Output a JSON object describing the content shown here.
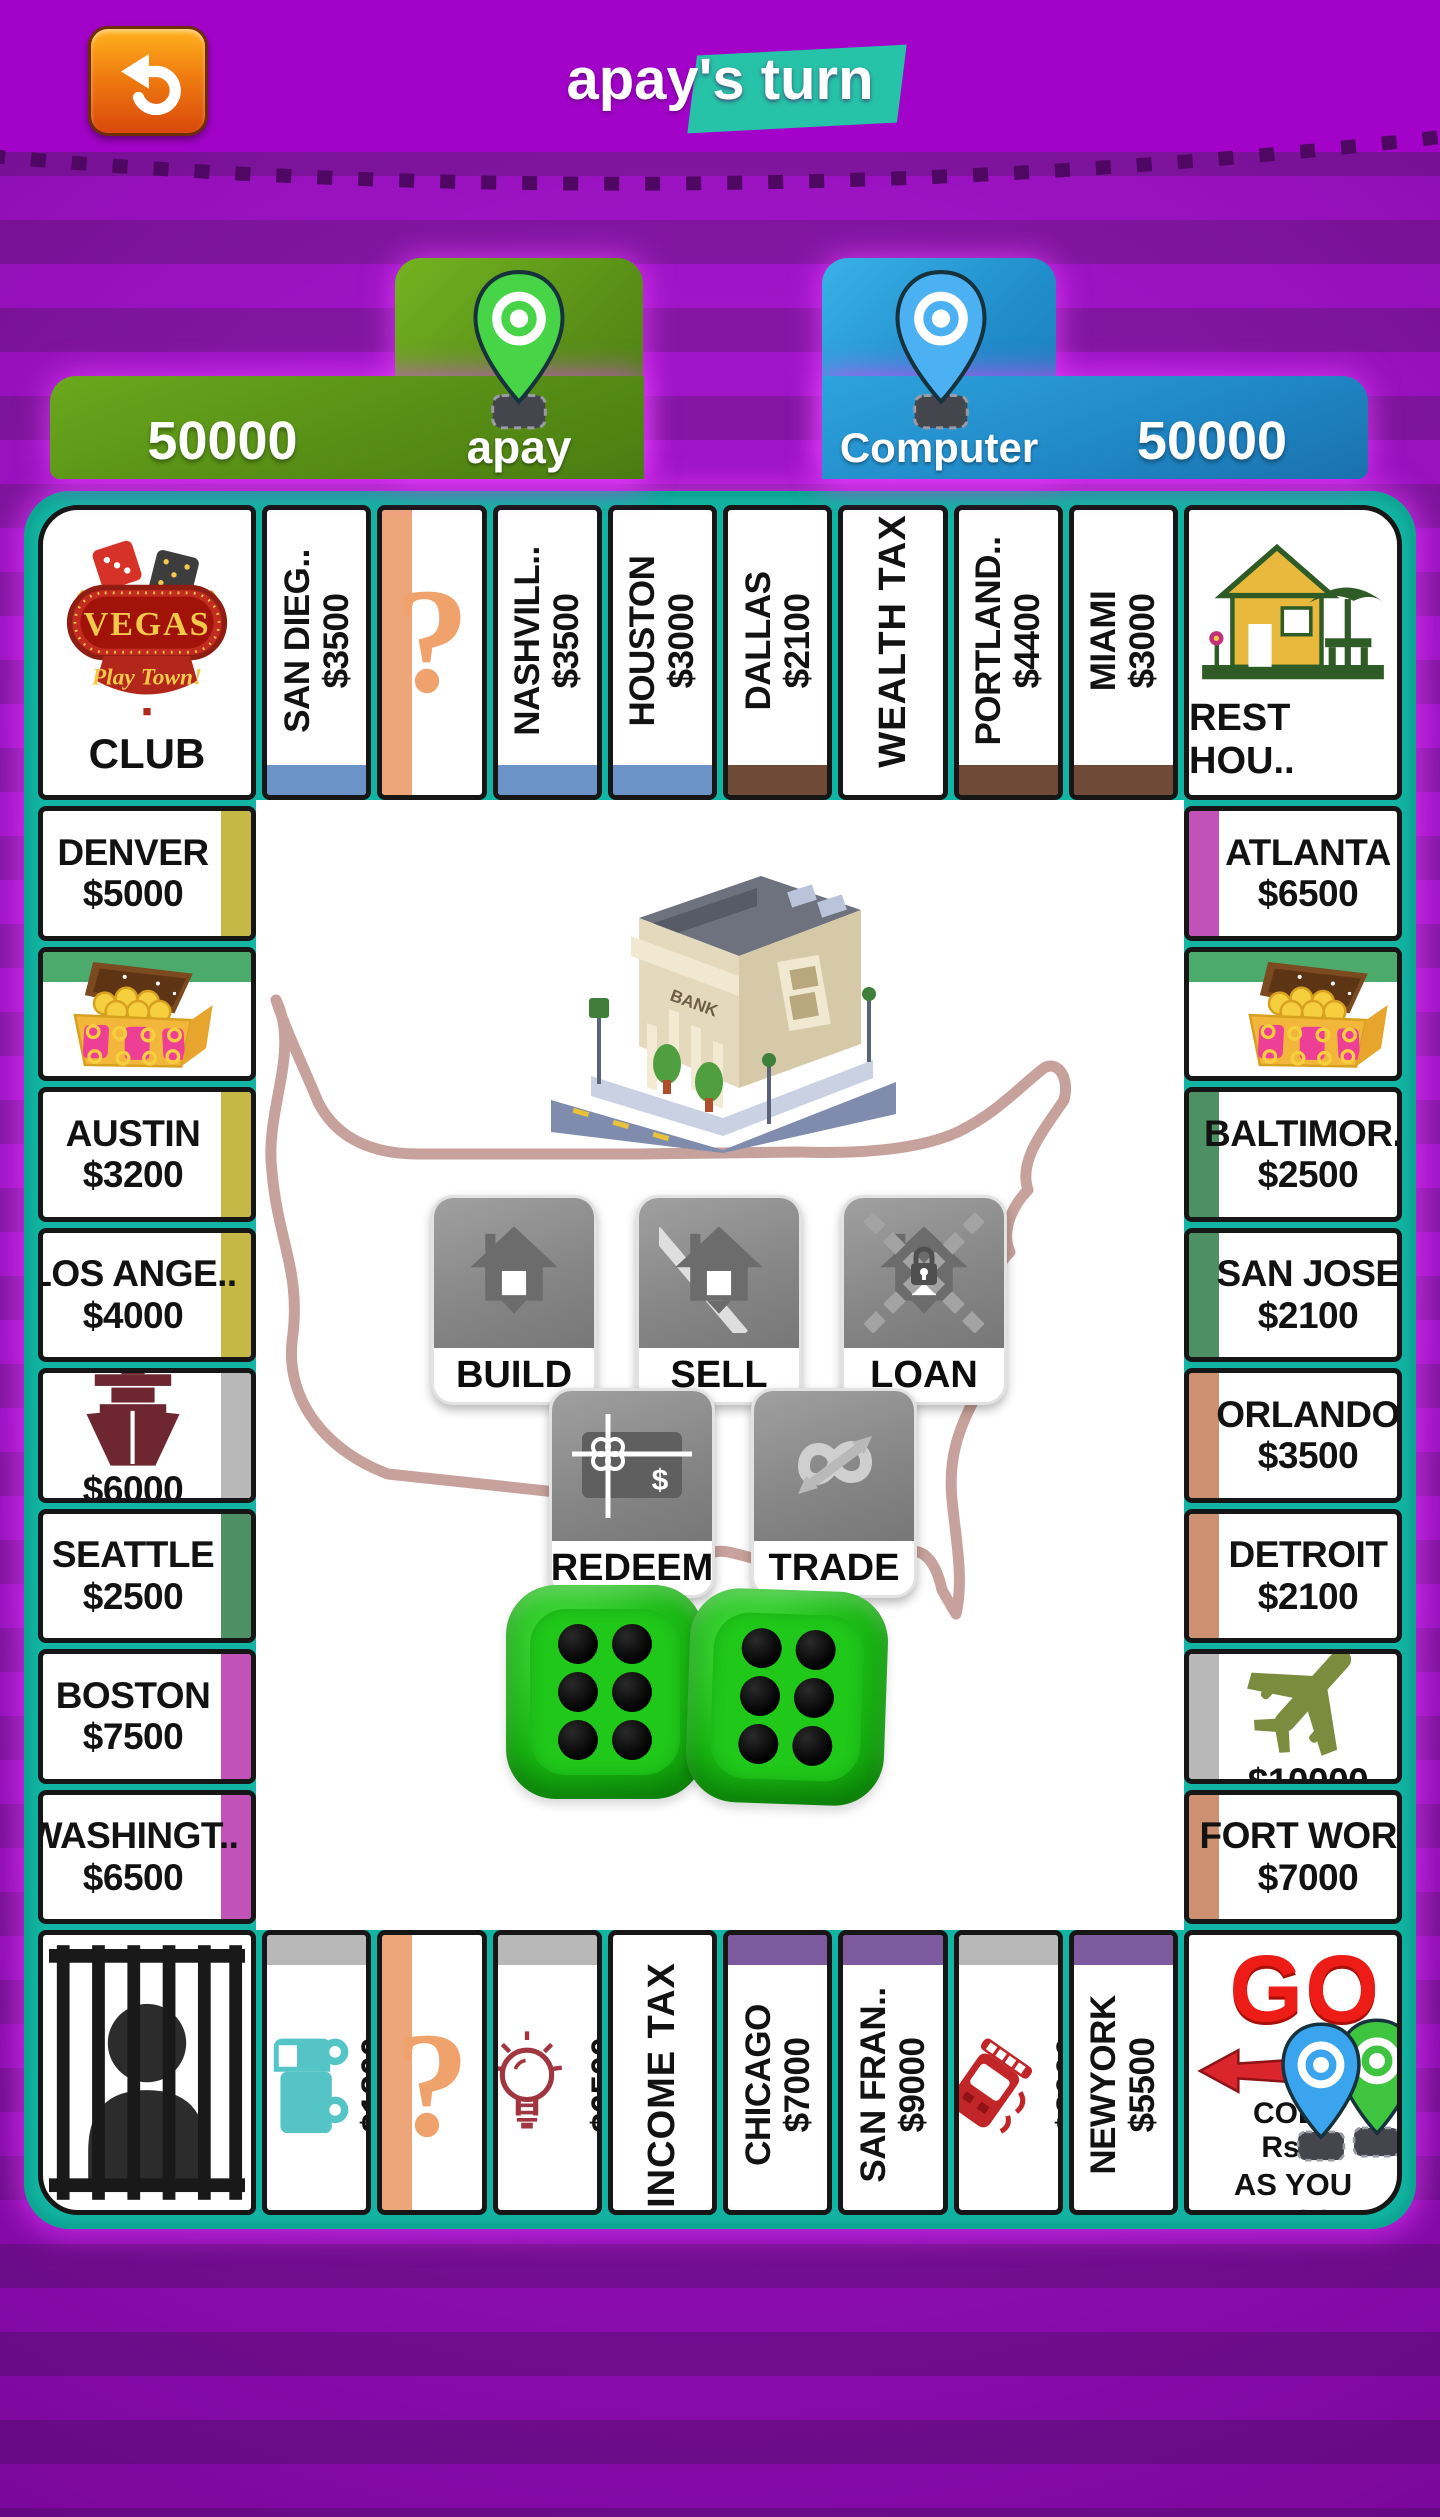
{
  "header": {
    "title": "apay's turn",
    "back_icon": "undo-arrow-icon"
  },
  "players": [
    {
      "name": "apay",
      "balance": "50000",
      "panel_color": "#5a9216",
      "pin_color": "#47d447"
    },
    {
      "name": "Computer",
      "balance": "50000",
      "panel_color": "#2191cf",
      "pin_color": "#4cb1f2"
    }
  ],
  "board": {
    "frame_color": "#12b5a3",
    "corners": {
      "top_left": {
        "sign_word": "VEGAS",
        "sign_script": "Play Town!",
        "label": "CLUB"
      },
      "top_right": {
        "label": "REST HOU.."
      },
      "bottom_left": {
        "icon": "jail-icon"
      },
      "bottom_right": {
        "word": "GO",
        "line1": "COL..",
        "line2": "Rs...",
        "line3": "AS YOU PASS"
      }
    },
    "top_row": [
      {
        "type": "city",
        "name": "SAN DIEG..",
        "price": "$3500",
        "band": "#6b93c7"
      },
      {
        "type": "chance",
        "symbol": "?",
        "band": "#eda57a",
        "band_side": "left"
      },
      {
        "type": "city",
        "name": "NASHVILL..",
        "price": "$3500",
        "band": "#6b93c7"
      },
      {
        "type": "city",
        "name": "HOUSTON",
        "price": "$3000",
        "band": "#6b93c7"
      },
      {
        "type": "city",
        "name": "DALLAS",
        "price": "$2100",
        "band": "#6f4a37"
      },
      {
        "type": "tax",
        "name": "WEALTH TAX"
      },
      {
        "type": "city",
        "name": "PORTLAND..",
        "price": "$4400",
        "band": "#6f4a37"
      },
      {
        "type": "city",
        "name": "MIAMI",
        "price": "$3000",
        "band": "#6f4a37"
      }
    ],
    "left_col": [
      {
        "type": "city",
        "name": "DENVER",
        "price": "$5000",
        "band": "#c5b844"
      },
      {
        "type": "chest",
        "icon": "treasure-chest-icon",
        "band": "#4caa6c",
        "band_side": "top"
      },
      {
        "type": "city",
        "name": "AUSTIN",
        "price": "$3200",
        "band": "#c5b844"
      },
      {
        "type": "city",
        "name": "LOS ANGE..",
        "price": "$4000",
        "band": "#c5b844"
      },
      {
        "type": "util",
        "icon": "ship-icon",
        "price": "$6000",
        "band": "#b8b8b8"
      },
      {
        "type": "city",
        "name": "SEATTLE",
        "price": "$2500",
        "band": "#4c9064"
      },
      {
        "type": "city",
        "name": "BOSTON",
        "price": "$7500",
        "band": "#c152b8"
      },
      {
        "type": "city",
        "name": "WASHINGT..",
        "price": "$6500",
        "band": "#c152b8"
      }
    ],
    "right_col": [
      {
        "type": "city",
        "name": "ATLANTA",
        "price": "$6500",
        "band": "#c152b8"
      },
      {
        "type": "chest",
        "icon": "treasure-chest-icon",
        "band": "#4caa6c",
        "band_side": "top"
      },
      {
        "type": "city",
        "name": "BALTIMOR..",
        "price": "$2500",
        "band": "#4c9064"
      },
      {
        "type": "city",
        "name": "SAN JOSE",
        "price": "$2100",
        "band": "#4c9064"
      },
      {
        "type": "city",
        "name": "ORLANDO",
        "price": "$3500",
        "band": "#cd9070"
      },
      {
        "type": "city",
        "name": "DETROIT",
        "price": "$2100",
        "band": "#cd9070"
      },
      {
        "type": "util",
        "icon": "plane-icon",
        "price": "$10000",
        "band": "#b8b8b8"
      },
      {
        "type": "city",
        "name": "FORT WOR..",
        "price": "$7000",
        "band": "#cd9070"
      }
    ],
    "bottom_row": [
      {
        "type": "util",
        "icon": "truck-icon",
        "price": "$1800",
        "band": "#b8b8b8"
      },
      {
        "type": "chance",
        "symbol": "?",
        "band": "#eda57a",
        "band_side": "left"
      },
      {
        "type": "util",
        "icon": "bulb-icon",
        "price": "$6500",
        "band": "#b8b8b8",
        "counter": true
      },
      {
        "type": "tax",
        "name": "INCOME TAX"
      },
      {
        "type": "city",
        "name": "CHICAGO",
        "price": "$7000",
        "band": "#7d5a9e"
      },
      {
        "type": "city",
        "name": "SAN FRAN..",
        "price": "$9000",
        "band": "#7d5a9e"
      },
      {
        "type": "util",
        "icon": "train-icon",
        "price": "$8000",
        "band": "#b8b8b8",
        "counter": true
      },
      {
        "type": "city",
        "name": "NEWYORK",
        "price": "$5500",
        "band": "#7d5a9e"
      }
    ]
  },
  "center": {
    "bank_sign": "BANK",
    "actions": [
      {
        "label": "BUILD",
        "icon": "build-house-icon",
        "x": 175,
        "y": 395
      },
      {
        "label": "SELL",
        "icon": "sell-house-icon",
        "x": 380,
        "y": 395
      },
      {
        "label": "LOAN",
        "icon": "loan-house-icon",
        "x": 585,
        "y": 395
      },
      {
        "label": "REDEEM",
        "icon": "redeem-cheque-icon",
        "x": 293,
        "y": 588
      },
      {
        "label": "TRADE",
        "icon": "trade-arrows-icon",
        "x": 495,
        "y": 588
      }
    ],
    "dice": {
      "values": [
        6,
        6
      ],
      "color": "#1fc214"
    }
  }
}
